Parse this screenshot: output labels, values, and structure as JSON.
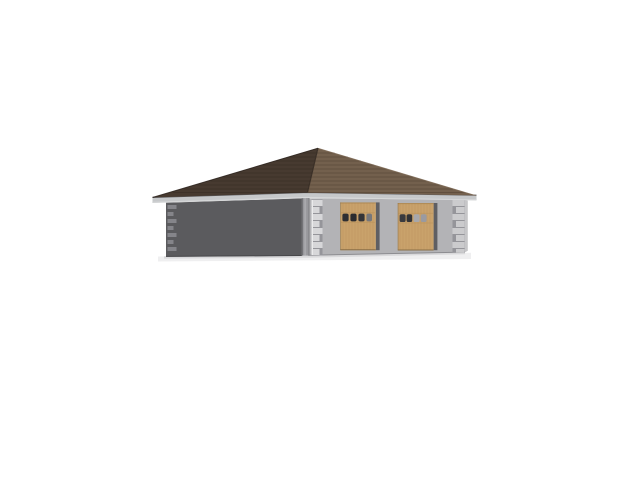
{
  "scene": {
    "type": "3d-architectural-render",
    "subject": "Two-car detached garage with pyramidal hip roof viewed from front-left",
    "background": "#ffffff"
  },
  "roof": {
    "left_plane_color": "#473a30",
    "front_plane_color": "#73604d",
    "front_shingle_line_color": "#5a4839",
    "left_shingle_line_color": "#382d25",
    "ridge_edge_color": "#352b23",
    "top_edge_color": "#2f2620",
    "edge_highlight_color": "#8d7965"
  },
  "eave": {
    "fascia_color": "#c6c8ca",
    "fascia_top_edge": "#5e5e62",
    "fascia_bottom_edge": "#d8d9da"
  },
  "walls": {
    "side_color": "#5b5b5e",
    "front_color": "#b3b3b6",
    "right_edge_color": "#c6c6c8",
    "side_bottom_edge": "#47474a",
    "front_bottom_edge": "#8d8d91"
  },
  "quoins": {
    "front_color": "#d7d7d9",
    "right_color": "#cbcbcd",
    "gap_color": "#95959a",
    "side_color": "#85858a",
    "highlight": "#ebebec"
  },
  "downspout": {
    "body": "#98989c",
    "edge": "#6a6a6e",
    "highlight": "#aeaeb2",
    "elbow": "#a6a6aa"
  },
  "doors": {
    "panel_color": "#c9a26b",
    "grain_color": "#b68e58",
    "top_edge": "#a8834f",
    "bottom_edge": "#8a6f47",
    "jamb_color": "#5f5f63",
    "left": {
      "windows": [
        "#2e2e32",
        "#2b2b2f",
        "#343438",
        "#77777b"
      ]
    },
    "right": {
      "windows": [
        "#3a3a3e",
        "#323236",
        "#a7a7ab",
        "#9a9aa0"
      ]
    }
  },
  "shadow": {
    "soft": "#e4e4e6",
    "hard": "#bfbfc2"
  }
}
